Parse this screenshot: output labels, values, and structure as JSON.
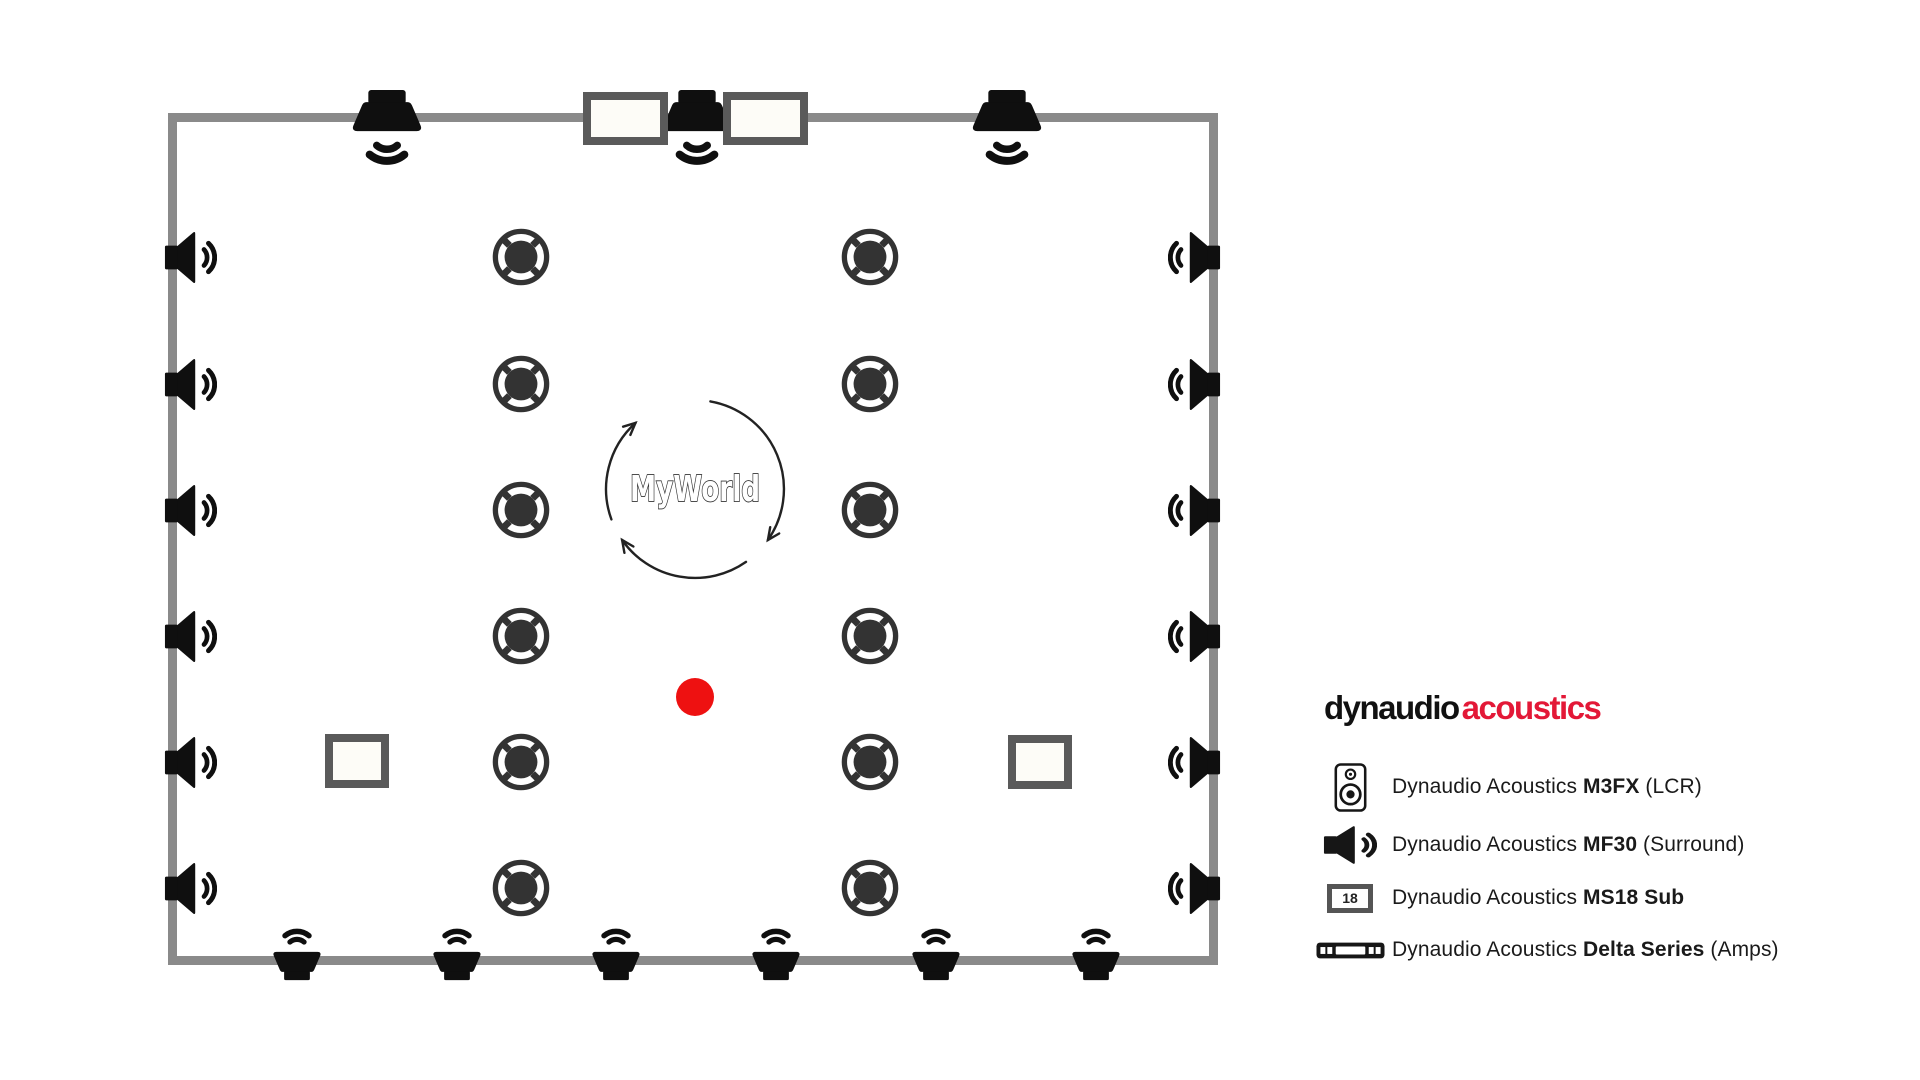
{
  "colors": {
    "wall": "#8a8a8a",
    "icon-black": "#0f0f0f",
    "ceiling-icon": "#333333",
    "sub-border": "#5a5a5a",
    "sub-fill": "#fdfcf7",
    "listening-dot": "#ee1111",
    "logo-black": "#111111",
    "logo-red": "#e31837",
    "legend-text": "#1a1a1a",
    "rotation-arrows": "#222222"
  },
  "room": {
    "left": 168,
    "top": 113,
    "width": 1050,
    "height": 852,
    "wall_thickness": 9
  },
  "speakers": {
    "lcr_top": {
      "wall_y": 117,
      "xs": [
        387,
        697,
        1007
      ]
    },
    "surround_left": {
      "wall_x": 172,
      "ys": [
        257,
        384,
        510,
        636,
        762,
        888
      ]
    },
    "surround_right": {
      "wall_x": 1213,
      "ys": [
        257,
        384,
        510,
        636,
        762,
        888
      ]
    },
    "surround_bottom": {
      "wall_y": 961,
      "xs": [
        297,
        457,
        616,
        776,
        936,
        1096
      ]
    },
    "ceiling_left_column": {
      "x": 521,
      "ys": [
        257,
        384,
        510,
        636,
        762,
        888
      ]
    },
    "ceiling_right_column": {
      "x": 870,
      "ys": [
        257,
        384,
        510,
        636,
        762,
        888
      ]
    },
    "subs_top_wall": [
      {
        "x": 625,
        "y": 118
      },
      {
        "x": 765,
        "y": 118
      }
    ],
    "subs_floor": [
      {
        "x": 357,
        "y": 761
      },
      {
        "x": 1040,
        "y": 762
      }
    ]
  },
  "center_logo": {
    "text": "MyWorld",
    "cx": 695,
    "cy": 489,
    "circle_diameter": 178
  },
  "listening_point": {
    "x": 695,
    "y": 697,
    "diameter": 38
  },
  "brand": {
    "text_black": "dynaudio",
    "text_red": "acoustics",
    "x": 1324,
    "y": 691
  },
  "legend": {
    "x": 1308,
    "text_offset": 84,
    "rows": [
      {
        "icon": "cabinet-speaker-icon",
        "y": 787,
        "prefix": "Dynaudio Acoustics ",
        "bold": "M3FX",
        "suffix": " (LCR)"
      },
      {
        "icon": "surround-speaker-icon",
        "y": 845,
        "prefix": "Dynaudio Acoustics ",
        "bold": "MF30",
        "suffix": " (Surround)"
      },
      {
        "icon": "subwoofer-icon",
        "icon_label": "18",
        "y": 898,
        "prefix": "Dynaudio Acoustics ",
        "bold": "MS18 Sub",
        "suffix": ""
      },
      {
        "icon": "amplifier-icon",
        "y": 950,
        "prefix": "Dynaudio Acoustics ",
        "bold": "Delta Series",
        "suffix": " (Amps)"
      }
    ]
  }
}
